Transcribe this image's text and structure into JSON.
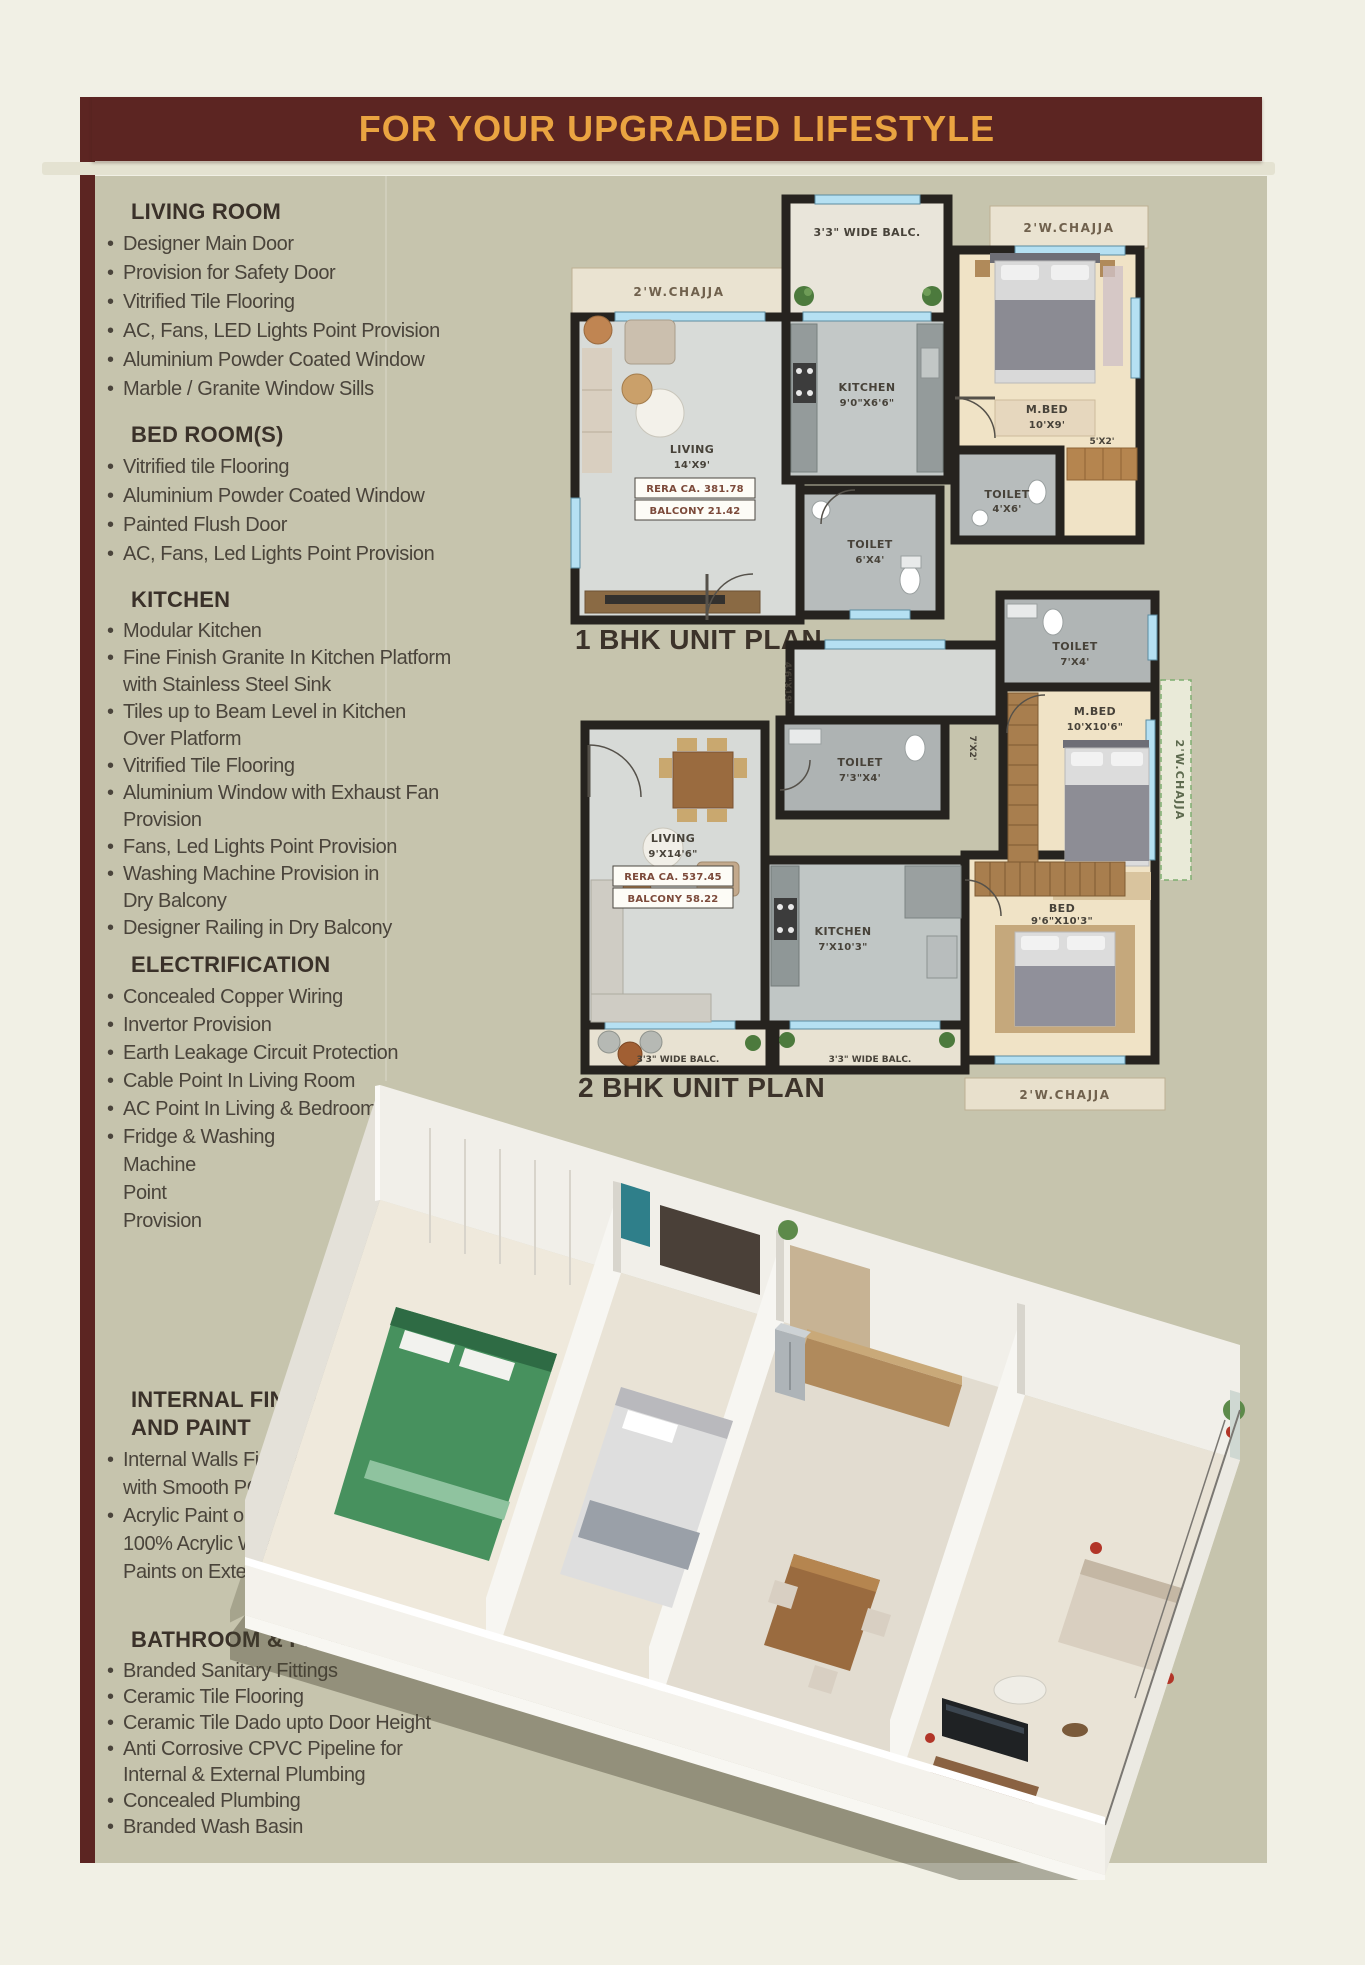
{
  "colors": {
    "banner_bg": "#5c2522",
    "banner_text": "#eaa441",
    "panel_bg": "#c6c4ad",
    "wall": "#26231f",
    "window_blue": "#b5e0f2"
  },
  "banner": {
    "title": "FOR YOUR UPGRADED LIFESTYLE"
  },
  "specs": {
    "sections": [
      {
        "title": [
          "LIVING ROOM"
        ],
        "items": [
          [
            "Designer Main Door"
          ],
          [
            "Provision for Safety Door"
          ],
          [
            "Vitrified Tile Flooring"
          ],
          [
            "AC, Fans, LED Lights Point Provision"
          ],
          [
            "Aluminium Powder Coated Window"
          ],
          [
            "Marble / Granite Window Sills"
          ]
        ]
      },
      {
        "title": [
          "BED ROOM(S)"
        ],
        "items": [
          [
            "Vitrified tile Flooring"
          ],
          [
            "Aluminium Powder Coated Window"
          ],
          [
            "Painted Flush Door"
          ],
          [
            "AC, Fans, Led Lights Point Provision"
          ]
        ]
      },
      {
        "title": [
          "KITCHEN"
        ],
        "items": [
          [
            "Modular Kitchen"
          ],
          [
            "Fine Finish Granite In Kitchen Platform",
            "with Stainless Steel Sink"
          ],
          [
            "Tiles up to Beam Level in Kitchen",
            "Over Platform"
          ],
          [
            "Vitrified Tile Flooring"
          ],
          [
            "Aluminium Window with Exhaust Fan",
            "Provision"
          ],
          [
            "Fans, Led Lights Point Provision"
          ],
          [
            "Washing Machine Provision in",
            "Dry Balcony"
          ],
          [
            "Designer Railing in Dry Balcony"
          ]
        ]
      },
      {
        "title": [
          "ELECTRIFICATION"
        ],
        "items": [
          [
            "Concealed Copper Wiring"
          ],
          [
            "Invertor Provision"
          ],
          [
            "Earth Leakage Circuit Protection"
          ],
          [
            "Cable Point In Living Room"
          ],
          [
            "AC Point In Living & Bedroom"
          ],
          [
            "Fridge & Washing",
            "Machine",
            "Point",
            "Provision"
          ]
        ]
      },
      {
        "title": [
          "INTERNAL FINISH",
          "AND PAINT"
        ],
        "items": [
          [
            "Internal Walls Finished",
            "with Smooth POP Finish"
          ],
          [
            "Acrylic Paint on Internal Walls",
            "100% Acrylic Waterproof Anti Fungal",
            "Paints on External Walls"
          ]
        ]
      },
      {
        "title": [
          "BATHROOM & PLUMBING"
        ],
        "items": [
          [
            "Branded Sanitary Fittings"
          ],
          [
            "Ceramic Tile Flooring"
          ],
          [
            "Ceramic Tile Dado upto Door Height"
          ],
          [
            "Anti Corrosive CPVC Pipeline for",
            "Internal & External Plumbing"
          ],
          [
            "Concealed Plumbing"
          ],
          [
            "Branded Wash Basin"
          ]
        ]
      }
    ]
  },
  "plans": {
    "plan1": {
      "caption": "1 BHK UNIT PLAN",
      "labels": {
        "balc_top": "3'3\" WIDE BALC.",
        "chajja_left": "2'W.CHAJJA",
        "chajja_right": "2'W.CHAJJA",
        "kitchen": "KITCHEN",
        "kitchen_dim": "9'0\"X6'6\"",
        "mbed": "M.BED",
        "mbed_dim": "10'X9'",
        "wardrobe_dim": "5'X2'",
        "living": "LIVING",
        "living_dim": "14'X9'",
        "rera": "RERA CA. 381.78",
        "balcony_area": "BALCONY 21.42",
        "toilet_a": "TOILET",
        "toilet_a_dim": "6'X4'",
        "toilet_b": "TOILET",
        "toilet_b_dim": "4'X6'"
      }
    },
    "plan2": {
      "caption": "2 BHK UNIT PLAN",
      "labels": {
        "toilet_top": "TOILET",
        "toilet_top_dim": "7'X4'",
        "mbed": "M.BED",
        "mbed_dim": "10'X10'6\"",
        "chajja_right": "2'W.CHAJJA",
        "dim_a": "7'X2'",
        "toilet_mid": "TOILET",
        "toilet_mid_dim": "7'3\"X4'",
        "dim_b": "4'6\"X19'",
        "living": "LIVING",
        "living_dim": "9'X14'6\"",
        "rera": "RERA CA. 537.45",
        "balcony_area": "BALCONY 58.22",
        "kitchen": "KITCHEN",
        "kitchen_dim": "7'X10'3\"",
        "bed": "BED",
        "bed_dim": "9'6\"X10'3\"",
        "balc_left": "3'3\" WIDE BALC.",
        "balc_right": "3'3\" WIDE BALC.",
        "chajja_bottom": "2'W.CHAJJA"
      }
    }
  }
}
